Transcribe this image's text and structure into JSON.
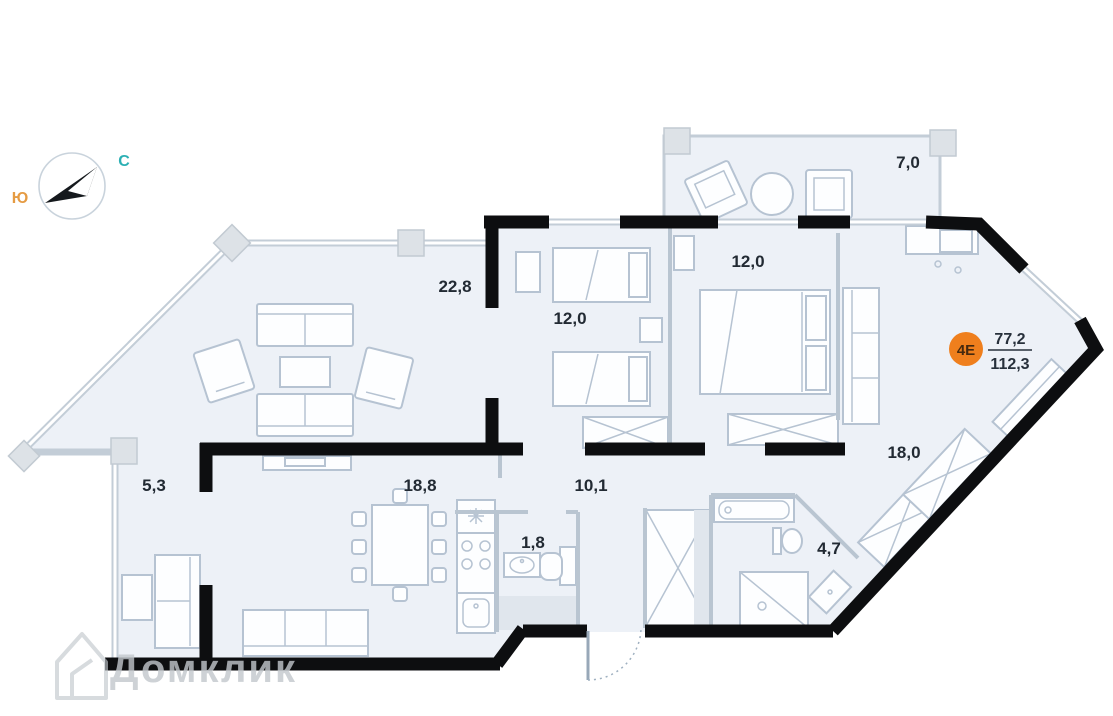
{
  "compass": {
    "south_label": "Ю",
    "north_label": "С"
  },
  "unit_badge": {
    "label": "4Е",
    "living_area": "77,2",
    "total_area": "112,3"
  },
  "rooms": [
    {
      "id": "balcony-top",
      "area": "7,0"
    },
    {
      "id": "living-room",
      "area": "22,8"
    },
    {
      "id": "bedroom-1",
      "area": "12,0"
    },
    {
      "id": "bedroom-2",
      "area": "12,0"
    },
    {
      "id": "hall",
      "area": "18,0"
    },
    {
      "id": "loggia-left",
      "area": "5,3"
    },
    {
      "id": "kitchen-dining",
      "area": "18,8"
    },
    {
      "id": "corridor",
      "area": "10,1"
    },
    {
      "id": "wc",
      "area": "1,8"
    },
    {
      "id": "bathroom",
      "area": "4,7"
    }
  ],
  "watermark": "Домклик",
  "colors": {
    "wall": "#0d0e10",
    "window": "#c3cdd7",
    "room_fill": "#edf1f7",
    "furniture": "#b6c3d2",
    "badge_orange": "#ef7f1d",
    "compass_south": "#e59b43",
    "compass_north": "#2cb0b4"
  }
}
